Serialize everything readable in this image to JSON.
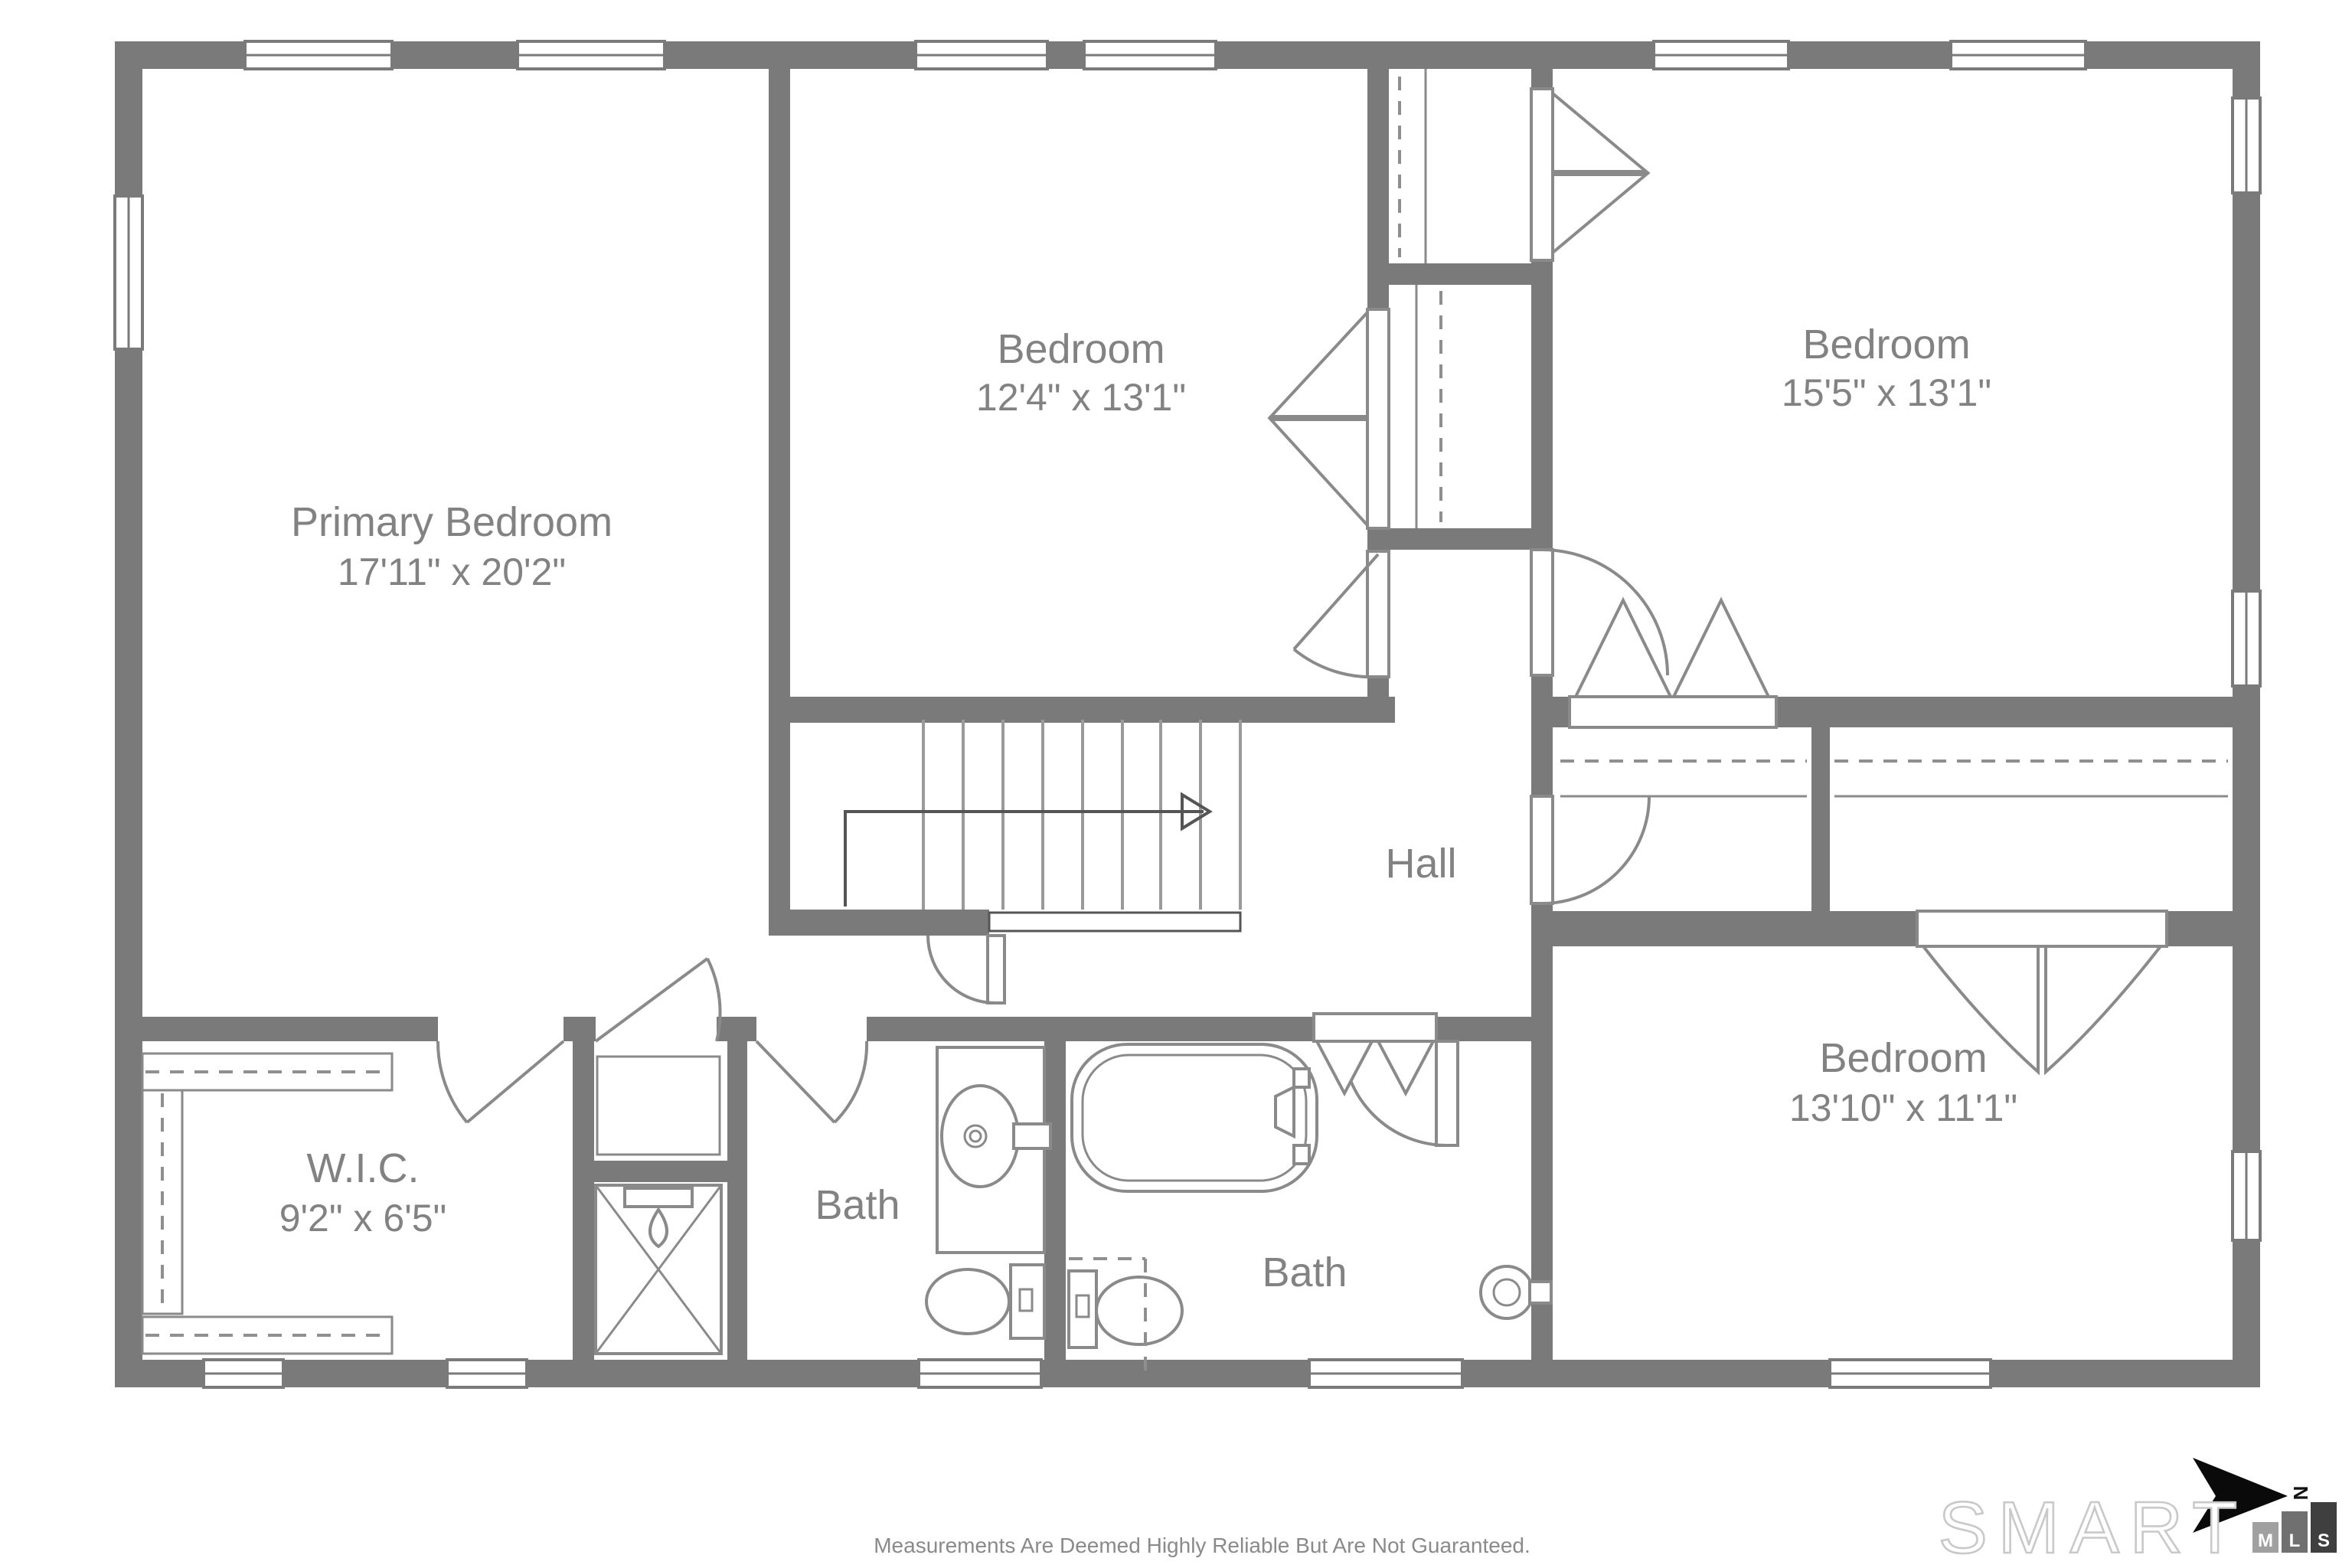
{
  "rooms": {
    "primary": {
      "name": "Primary Bedroom",
      "dims": "17'11\" x 20'2\""
    },
    "bedroom2": {
      "name": "Bedroom",
      "dims": "12'4\" x 13'1\""
    },
    "bedroom3": {
      "name": "Bedroom",
      "dims": "15'5\" x 13'1\""
    },
    "bedroom4": {
      "name": "Bedroom",
      "dims": "13'10\" x 11'1\""
    },
    "hall": {
      "name": "Hall"
    },
    "wic": {
      "name": "W.I.C.",
      "dims": "9'2\" x 6'5\""
    },
    "bath_left": {
      "name": "Bath"
    },
    "bath_right": {
      "name": "Bath"
    }
  },
  "footer": {
    "disclaimer": "Measurements Are Deemed Highly Reliable But Are Not Guaranteed."
  },
  "logo": {
    "brand": "SMART",
    "mls": [
      "M",
      "L",
      "S"
    ],
    "north_label": "N"
  },
  "colors": {
    "wall": "#7a7a7a",
    "fixture": "#8a8a8a",
    "label": "#828282",
    "mls_m": "#a0a0a0",
    "mls_l": "#707070",
    "mls_s": "#3f3f3f",
    "north_arrow": "#0a0a0a",
    "background": "#ffffff"
  }
}
